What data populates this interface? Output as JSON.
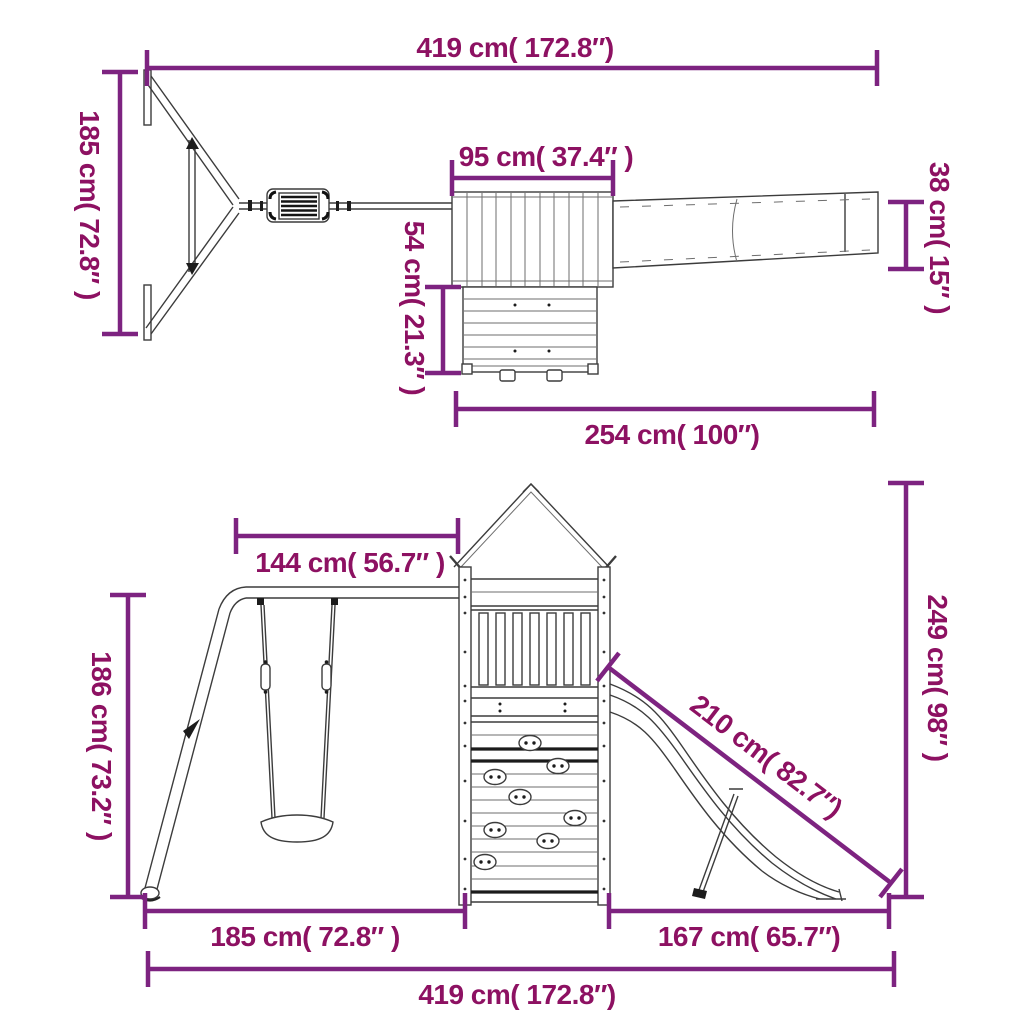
{
  "document": {
    "type": "product-dimension-diagram",
    "subject": "wooden playset with swing, playhouse tower and slide"
  },
  "colors": {
    "background": "#ffffff",
    "dimension_line": "#7d2380",
    "dimension_text": "#8d1162",
    "structure_line": "#3c3c3c",
    "structure_dark": "#1c1c1c"
  },
  "top_view": {
    "dimensions": {
      "total_width": "419 cm( 172.8″)",
      "swing_depth": "185 cm( 72.8″ )",
      "roof_width": "95 cm( 37.4″  )",
      "roof_depth": "54 cm( 21.3″ )",
      "slide_width": "38 cm( 15″ )",
      "tower_slide_length": "254 cm( 100″)"
    }
  },
  "side_view": {
    "dimensions": {
      "beam_length": "144 cm( 56.7″ )",
      "swing_height": "186 cm( 73.2″ )",
      "tower_height": "249 cm( 98″ )",
      "slide_length": "210 cm( 82.7″)",
      "swing_span": "185 cm( 72.8″ )",
      "slide_span": "167 cm( 65.7″)",
      "total_width": "419 cm( 172.8″)"
    }
  }
}
